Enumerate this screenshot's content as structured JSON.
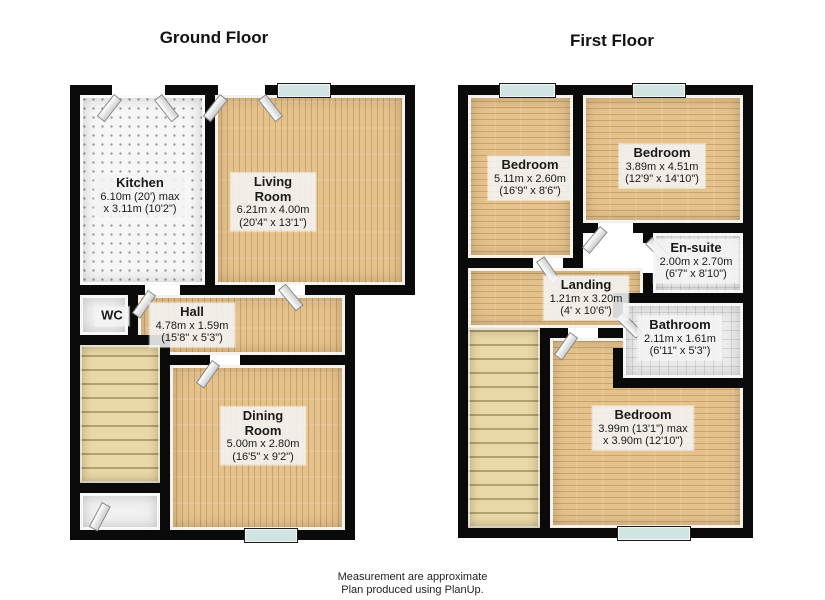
{
  "colors": {
    "wall": "#0a0a0a",
    "wood_floor": "#e5c28c",
    "wood_grain": "#8b5e28",
    "kitchen_floor": "#f6f6f6",
    "tile_floor": "#ebebeb",
    "stairs_floor": "#ead9a6",
    "window_glass": "#d2e4e1",
    "label_background": "#f2f2f2",
    "text": "#1a1a1a"
  },
  "ground": {
    "title": "Ground Floor",
    "rooms": [
      {
        "name": "Kitchen",
        "dim1": "6.10m (20') max",
        "dim2": "x 3.11m (10'2\")"
      },
      {
        "name": "Living Room",
        "dim1": "6.21m x 4.00m",
        "dim2": "(20'4\" x 13'1\")"
      },
      {
        "name": "Hall",
        "dim1": "4.78m x 1.59m",
        "dim2": "(15'8\" x 5'3\")"
      },
      {
        "name": "WC",
        "dim1": "",
        "dim2": ""
      },
      {
        "name": "Dining Room",
        "dim1": "5.00m x 2.80m",
        "dim2": "(16'5\" x 9'2\")"
      }
    ]
  },
  "first": {
    "title": "First Floor",
    "rooms": [
      {
        "name": "Bedroom",
        "dim1": "5.11m x 2.60m",
        "dim2": "(16'9\" x 8'6\")"
      },
      {
        "name": "Bedroom",
        "dim1": "3.89m x 4.51m",
        "dim2": "(12'9\" x 14'10\")"
      },
      {
        "name": "En-suite",
        "dim1": "2.00m x 2.70m",
        "dim2": "(6'7\" x 8'10\")"
      },
      {
        "name": "Landing",
        "dim1": "1.21m x 3.20m",
        "dim2": "(4' x 10'6\")"
      },
      {
        "name": "Bathroom",
        "dim1": "2.11m x 1.61m",
        "dim2": "(6'11\" x 5'3\")"
      },
      {
        "name": "Bedroom",
        "dim1": "3.99m (13'1\") max",
        "dim2": "x 3.90m (12'10\")"
      }
    ]
  },
  "footer": {
    "line1": "Measurement are approximate",
    "line2": "Plan produced using PlanUp."
  }
}
